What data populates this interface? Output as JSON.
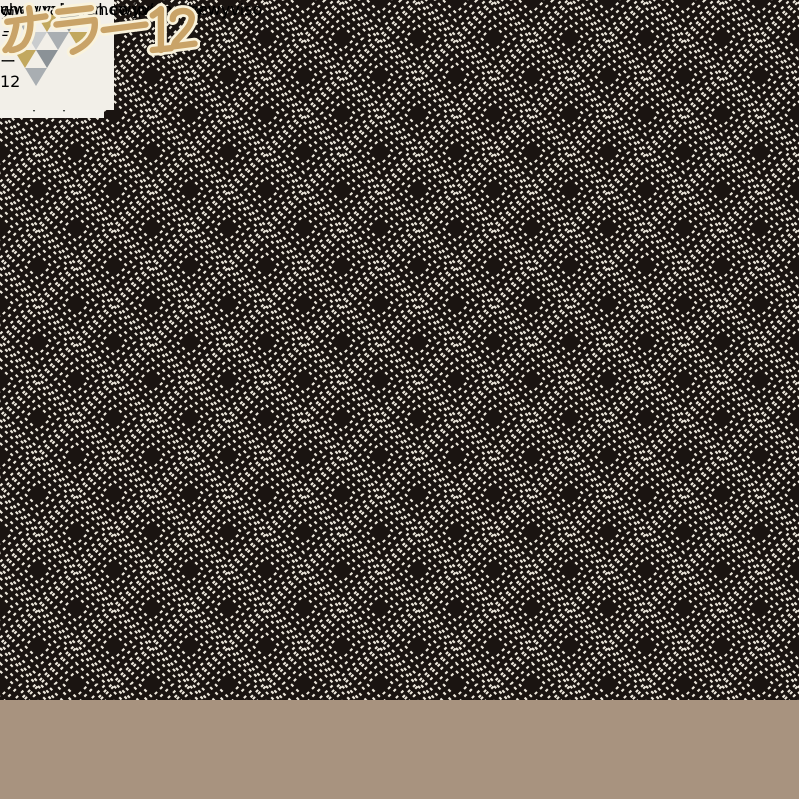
{
  "overlay": {
    "color_label": "カラー12",
    "diagonal_watermark": "chewyviso-chewyviso-chewyviso",
    "store_url": "www.rakuten.co.jp/chewy"
  },
  "wall_art": {
    "imagine_poster": {
      "title": "IMAGINE"
    },
    "hunger_games_poster": {
      "lines": [
        "THE",
        "HUNGER",
        "GAMES"
      ]
    }
  },
  "palette": {
    "label_gold": "#c9a368",
    "label_outline": "#faf3dc",
    "watermark_cream": "#ece3bb",
    "rug_black": "#1a1411",
    "rug_stitch_white": "#efeade",
    "teal_chair": "#2c5158",
    "mustard_yellow": "#d9a81c",
    "sofa_cream": "#ece6d9",
    "ottoman_slate": "#5d7181",
    "floor_wood": "#a8937f",
    "wall_greige": "#d6cfc5",
    "curtain_dark": "#23262c"
  }
}
